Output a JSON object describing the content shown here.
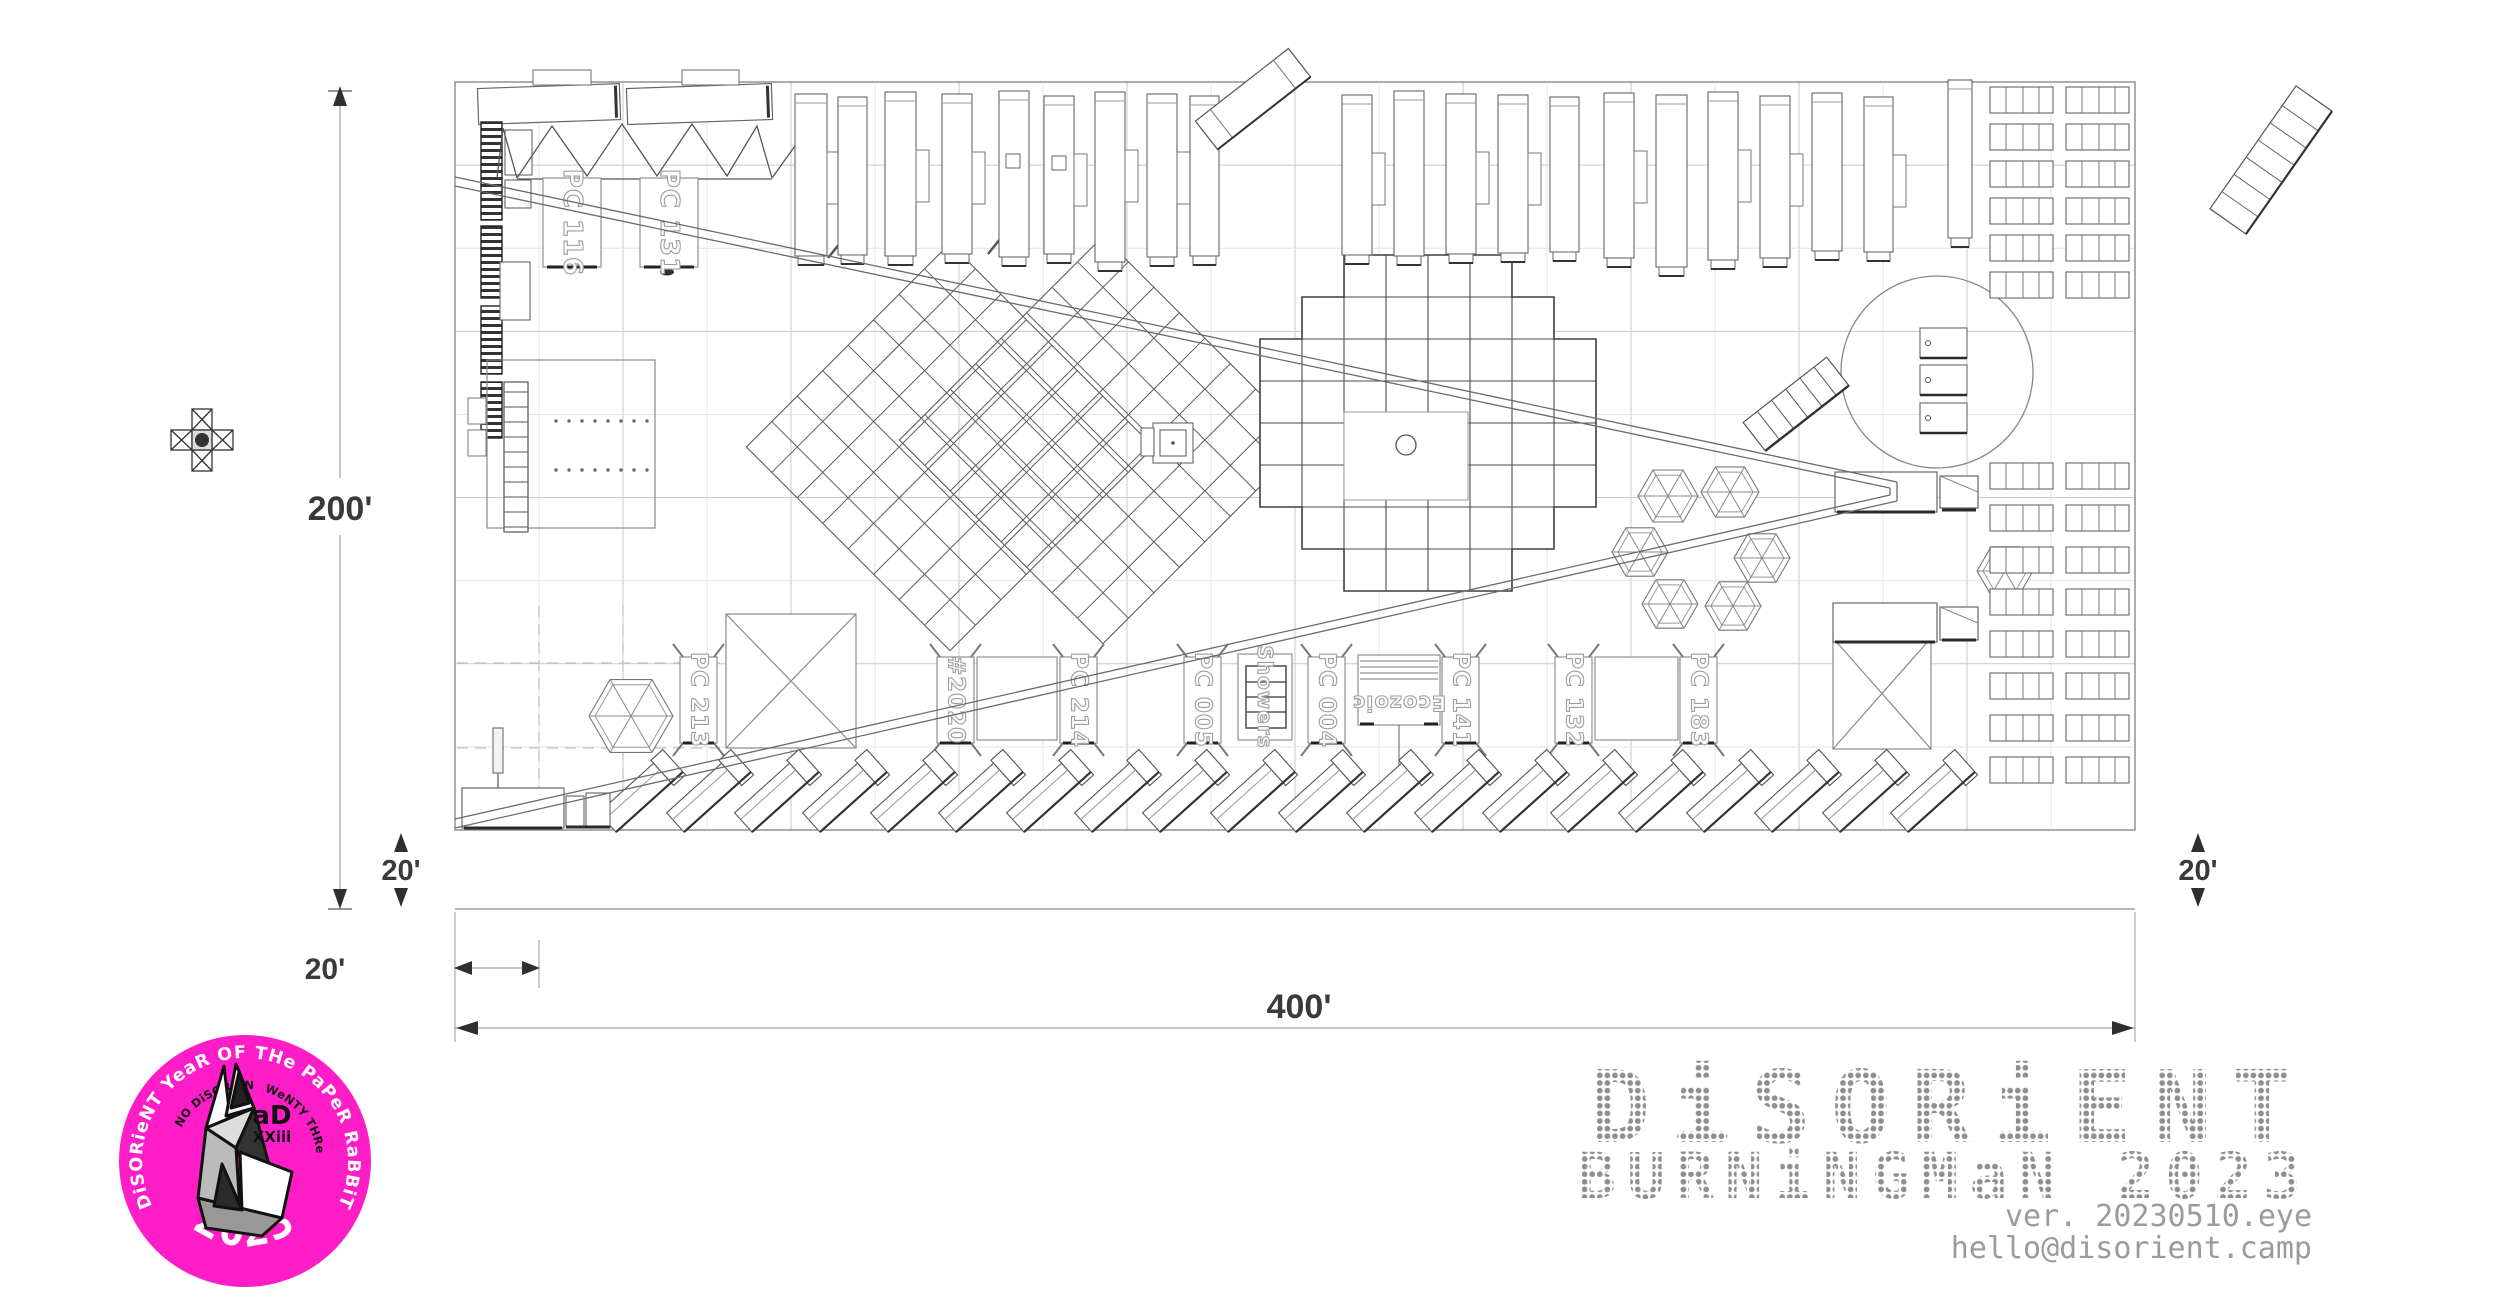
{
  "plan": {
    "dimension_labels": {
      "height": "200'",
      "width": "400'",
      "road_left": "20'",
      "road_right": "20'",
      "setback": "20'"
    },
    "containers_top": [
      {
        "x": 543,
        "label": "PC 116"
      },
      {
        "x": 640,
        "label": "PC 131"
      }
    ],
    "containers_bottom": [
      {
        "x": 680,
        "label": "PC 213"
      },
      {
        "x": 937,
        "label": "#2020"
      },
      {
        "x": 1060,
        "label": "PC 214"
      },
      {
        "x": 1184,
        "label": "PC 005"
      },
      {
        "x": 1308,
        "label": "PC 004"
      },
      {
        "x": 1442,
        "label": "PC 141"
      },
      {
        "x": 1555,
        "label": "PC 132"
      },
      {
        "x": 1680,
        "label": "PC 183"
      }
    ],
    "showers_label": "Showers",
    "ecozoic_label": "Ecozoic",
    "geometry": {
      "bounds": {
        "x": 455,
        "y": 82,
        "w": 1680,
        "h": 748
      },
      "outer_bottom_y": 909,
      "grid": {
        "dx": 84,
        "dy": 83.11,
        "cols": 20,
        "rows": 9
      },
      "diamonds": [
        {
          "cx": 950,
          "cy": 447,
          "halfside": 144,
          "cells": 8
        },
        {
          "cx": 1103,
          "cy": 440,
          "halfside": 144,
          "cells": 8
        }
      ],
      "plaza": {
        "x0": 1260,
        "y0": 255,
        "x1": 1596,
        "y1": 591,
        "cell": 42
      },
      "container_box": {
        "y": 657,
        "w": 37,
        "h": 86
      },
      "container_top_box": {
        "y": 178,
        "w": 58,
        "h": 89
      },
      "rvs": [
        [
          795,
          94,
          32,
          162,
          1
        ],
        [
          838,
          97,
          29,
          158,
          0
        ],
        [
          885,
          92,
          31,
          164,
          1
        ],
        [
          942,
          94,
          30,
          160,
          1
        ],
        [
          999,
          91,
          30,
          166,
          0
        ],
        [
          1044,
          96,
          30,
          158,
          1
        ],
        [
          1095,
          92,
          30,
          170,
          1
        ],
        [
          1147,
          94,
          30,
          163,
          1
        ],
        [
          1190,
          96,
          29,
          160,
          0
        ],
        [
          1342,
          95,
          30,
          160,
          1
        ],
        [
          1394,
          91,
          30,
          165,
          0
        ],
        [
          1446,
          94,
          30,
          160,
          1
        ],
        [
          1498,
          95,
          30,
          158,
          1
        ],
        [
          1550,
          97,
          29,
          155,
          0
        ],
        [
          1604,
          93,
          30,
          165,
          1
        ],
        [
          1656,
          95,
          31,
          172,
          0
        ],
        [
          1708,
          92,
          30,
          168,
          1
        ],
        [
          1760,
          96,
          30,
          162,
          1
        ],
        [
          1812,
          93,
          30,
          158,
          0
        ],
        [
          1864,
          97,
          29,
          155,
          1
        ],
        [
          1948,
          80,
          24,
          158,
          0
        ]
      ],
      "roof_boxes": [
        [
          1006,
          154,
          14,
          14
        ],
        [
          1052,
          156,
          14,
          14
        ]
      ],
      "diag_rvs": {
        "xs": [
          640,
          708,
          776,
          844,
          912,
          980,
          1048,
          1116,
          1184,
          1252,
          1320,
          1388,
          1456,
          1524,
          1592,
          1660,
          1728,
          1796,
          1864,
          1932
        ],
        "y": 793,
        "angle": -42
      },
      "hexes": [
        [
          1668,
          496,
          30
        ],
        [
          1730,
          492,
          29
        ],
        [
          1640,
          552,
          28
        ],
        [
          1762,
          558,
          28
        ],
        [
          1670,
          604,
          28
        ],
        [
          1733,
          606,
          28
        ],
        [
          2005,
          571,
          28
        ],
        [
          631,
          716,
          42
        ]
      ],
      "rows": {
        "cols_x": [
          1990,
          2066
        ],
        "w": 63,
        "h": 26,
        "top_ys": [
          87,
          124,
          161,
          198,
          235,
          272
        ],
        "bottom_ys": [
          463,
          505,
          547,
          589,
          631,
          673,
          715,
          757
        ]
      },
      "dome": {
        "cx": 1937,
        "cy": 372,
        "r": 96,
        "box_x": 1920,
        "box_w": 47,
        "box_h": 30,
        "box_ys": [
          328,
          365,
          403
        ]
      },
      "deck_dots": {
        "rows_y": [
          421,
          470
        ],
        "x0": 556,
        "step": 13,
        "n": 8
      }
    }
  },
  "badge": {
    "outer_text": "DiSORieNT YeaR OF THe PaPeR RaBBiT",
    "inner_left": "aNNO DiSORieNTi",
    "inner_right": "TWeNTY THRee",
    "year": "2023",
    "ad_line1": "aD",
    "ad_line2": "XXiii",
    "bg_color": "#ff1dc8"
  },
  "logo": {
    "title": "DiSORiENT",
    "subtitle": "BURNiNGMaN 2023",
    "version": "ver. 20230510.eye",
    "email": "hello@disorient.camp",
    "color": "#8f8f8f"
  }
}
